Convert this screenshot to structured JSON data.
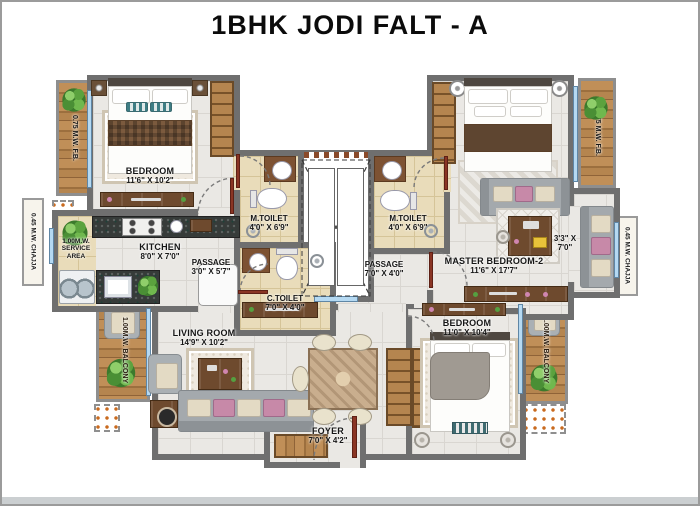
{
  "title": "1BHK JODI FALT - A",
  "colors": {
    "wall": "#6f6f6f",
    "floor_tile": "#eae8e4",
    "toilet_floor": "#e9dcba",
    "wood": "#b5854f",
    "window_blue": "#b5d9f2",
    "door_brown": "#8a3524"
  },
  "rooms": {
    "bedroom1": {
      "name": "BEDROOM",
      "dims": "11'6\" X 10'2\""
    },
    "kitchen": {
      "name": "KITCHEN",
      "dims": "8'0\" X 7'0\""
    },
    "service_area": {
      "name": "1.00M.W. SERVICE AREA"
    },
    "passage1": {
      "name": "PASSAGE",
      "dims": "3'0\" X 5'7\""
    },
    "mtoilet_left": {
      "name": "M.TOILET",
      "dims": "4'0\" X 6'9\""
    },
    "ctoilet": {
      "name": "C.TOILET",
      "dims": "7'0\" X 4'0\""
    },
    "mtoilet_right": {
      "name": "M.TOILET",
      "dims": "4'0\" X 6'9\""
    },
    "passage2": {
      "name": "PASSAGE",
      "dims": "7'0\" X 4'0\""
    },
    "living": {
      "name": "LIVING ROOM",
      "dims": "14'9\" X 10'2\""
    },
    "foyer": {
      "name": "FOYER",
      "dims": "7'0\" X 4'2\""
    },
    "master2": {
      "name": "MASTER BEDROOM-2",
      "dims": "11'6\" X 17'7\""
    },
    "nook": {
      "dims_line1": "3'3\" X",
      "dims_line2": "7'0\""
    },
    "bedroom2": {
      "name": "BEDROOM",
      "dims": "11'0\" X 10'4\""
    }
  },
  "exterior": {
    "fb_left": "0.75 M.W. F.B.",
    "fb_right": "0.75 M.W. F.B.",
    "chajja_left": "0.45 M.W. CHAJJA",
    "chajja_right": "0.45 M.W. CHAJJA",
    "balcony_left": "1.00M.W. BALCONY",
    "balcony_right": "1.00M.W. BALCONY",
    "lift": "lift-shaft"
  }
}
